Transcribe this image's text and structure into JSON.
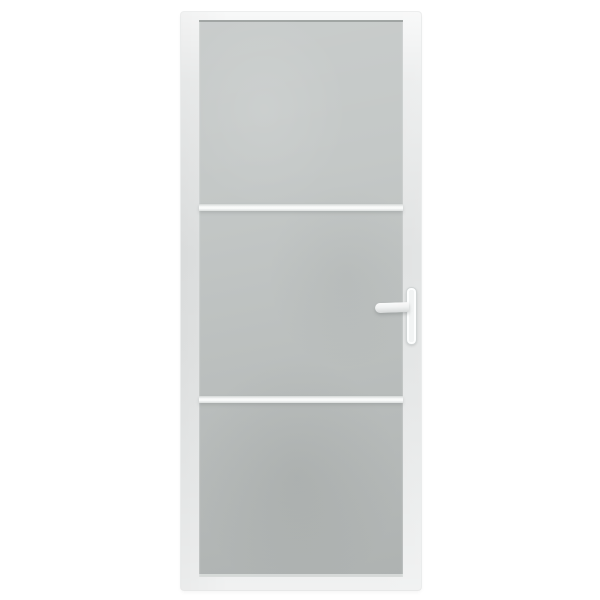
{
  "image": {
    "kind": "product-photo",
    "background_color": "#ffffff",
    "subject": "White interior door with frosted matt glass",
    "alt_text": "Interior door: white aluminium frame, three frosted glass panels separated by two white divider bars, white lever handle with vertical backplate on the right side"
  },
  "door": {
    "frame_color": "#e6e8e8",
    "glass": {
      "finish": "frosted",
      "panel_count": 3,
      "base_color": "#c3c7c6"
    },
    "dividers": {
      "count": 2,
      "color": "#eef1f0"
    },
    "handle": {
      "style": "lever",
      "side": "right",
      "plate_color": "#f2f4f4",
      "lever_color": "#eef0f0"
    }
  }
}
